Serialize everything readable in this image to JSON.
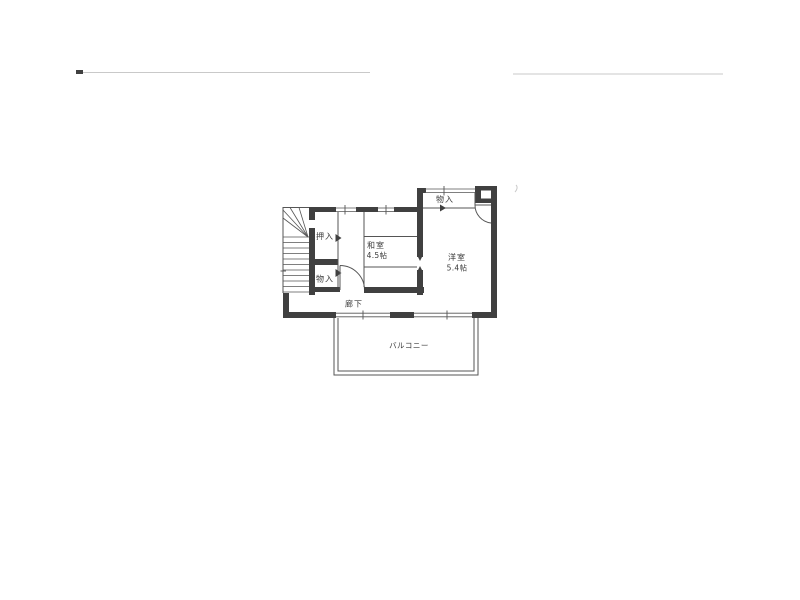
{
  "page": {
    "type": "scanned-floor-plan",
    "background": "#ffffff"
  },
  "colors": {
    "paper": "#ffffff",
    "wall": "#404040",
    "line": "#555555",
    "text": "#3a3a3a",
    "faint": "#c9c9c9"
  },
  "rooms": {
    "upper_storage": {
      "label": "物入"
    },
    "oshiire": {
      "label": "押入"
    },
    "washitsu": {
      "label": "和室",
      "size": "4.5帖"
    },
    "youshitsu": {
      "label": "洋室",
      "size": "5.4帖"
    },
    "lower_storage": {
      "label": "物入"
    },
    "corridor": {
      "label": "廊下"
    },
    "balcony": {
      "label": "バルコニー"
    }
  }
}
